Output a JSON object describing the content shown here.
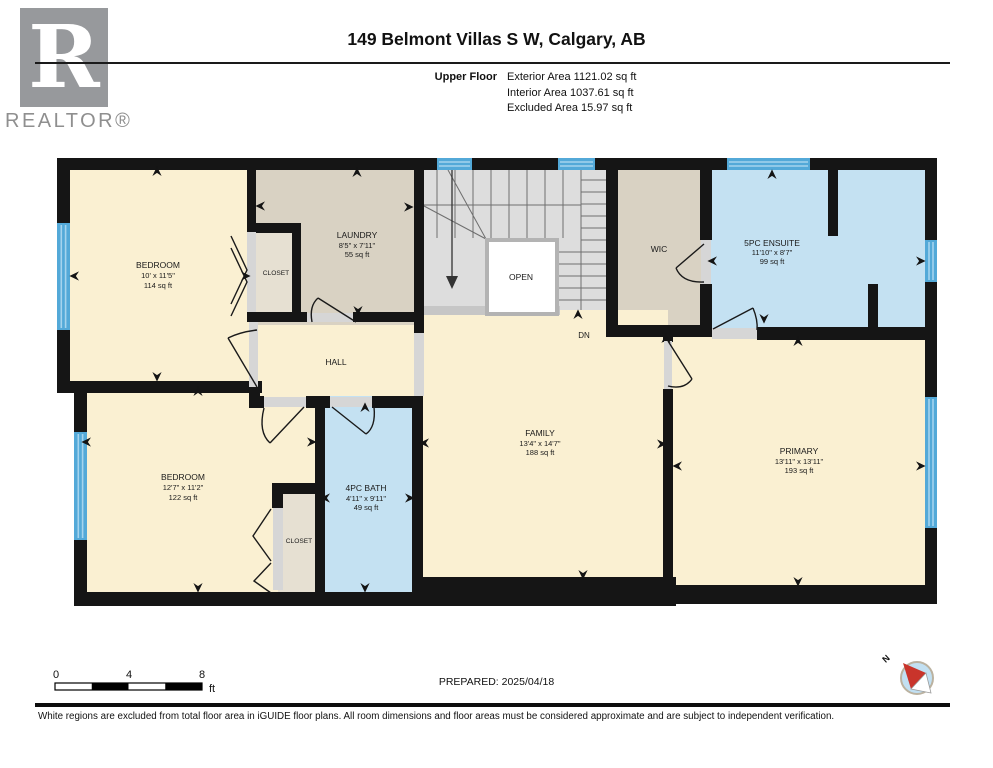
{
  "header": {
    "logo": {
      "letter": "R",
      "wordmark": "REALTOR®"
    },
    "title": "149 Belmont Villas S W, Calgary, AB",
    "floor_label": "Upper Floor",
    "area_lines": [
      "Exterior Area 1121.02 sq ft",
      "Interior Area 1037.61 sq ft",
      "Excluded Area 15.97 sq ft"
    ]
  },
  "rooms": {
    "bedroom_top": {
      "name": "BEDROOM",
      "dims": "10' x 11'5\"",
      "area": "114 sq ft"
    },
    "laundry": {
      "name": "LAUNDRY",
      "dims": "8'5\" x 7'11\"",
      "area": "55 sq ft"
    },
    "closet_top": {
      "name": "CLOSET"
    },
    "wic": {
      "name": "WIC"
    },
    "ensuite": {
      "name": "5PC ENSUITE",
      "dims": "11'10\" x 8'7\"",
      "area": "99 sq ft"
    },
    "hall": {
      "name": "HALL"
    },
    "stairs": {
      "open_label": "OPEN",
      "down_label": "DN"
    },
    "family": {
      "name": "FAMILY",
      "dims": "13'4\" x 14'7\"",
      "area": "188 sq ft"
    },
    "bedroom_bottom": {
      "name": "BEDROOM",
      "dims": "12'7\" x 11'2\"",
      "area": "122 sq ft"
    },
    "closet_bottom": {
      "name": "CLOSET"
    },
    "bath": {
      "name": "4PC BATH",
      "dims": "4'11\" x 9'11\"",
      "area": "49 sq ft"
    },
    "primary": {
      "name": "PRIMARY",
      "dims": "13'11\" x 13'11\"",
      "area": "193 sq ft"
    }
  },
  "footer": {
    "scale_bar": {
      "ticks": [
        "0",
        "4",
        "8"
      ],
      "unit": "ft"
    },
    "prepared": "PREPARED: 2025/04/18",
    "compass": {
      "north_label": "N"
    },
    "disclaimer": "White regions are excluded from total floor area in iGUIDE floor plans. All room dimensions and floor areas must be considered approximate and are subject to independent verification."
  },
  "colors": {
    "room_cream": "#FAF0D2",
    "room_beige": "#D9D2C3",
    "closet_beige": "#E6E0D2",
    "room_blue": "#C4E1F2",
    "stairs_gray": "#DDDDDD",
    "window_blue": "#53A9D8",
    "wall_black": "#151515",
    "compass_red": "#C9342B",
    "compass_blue": "#C2E0F2"
  }
}
